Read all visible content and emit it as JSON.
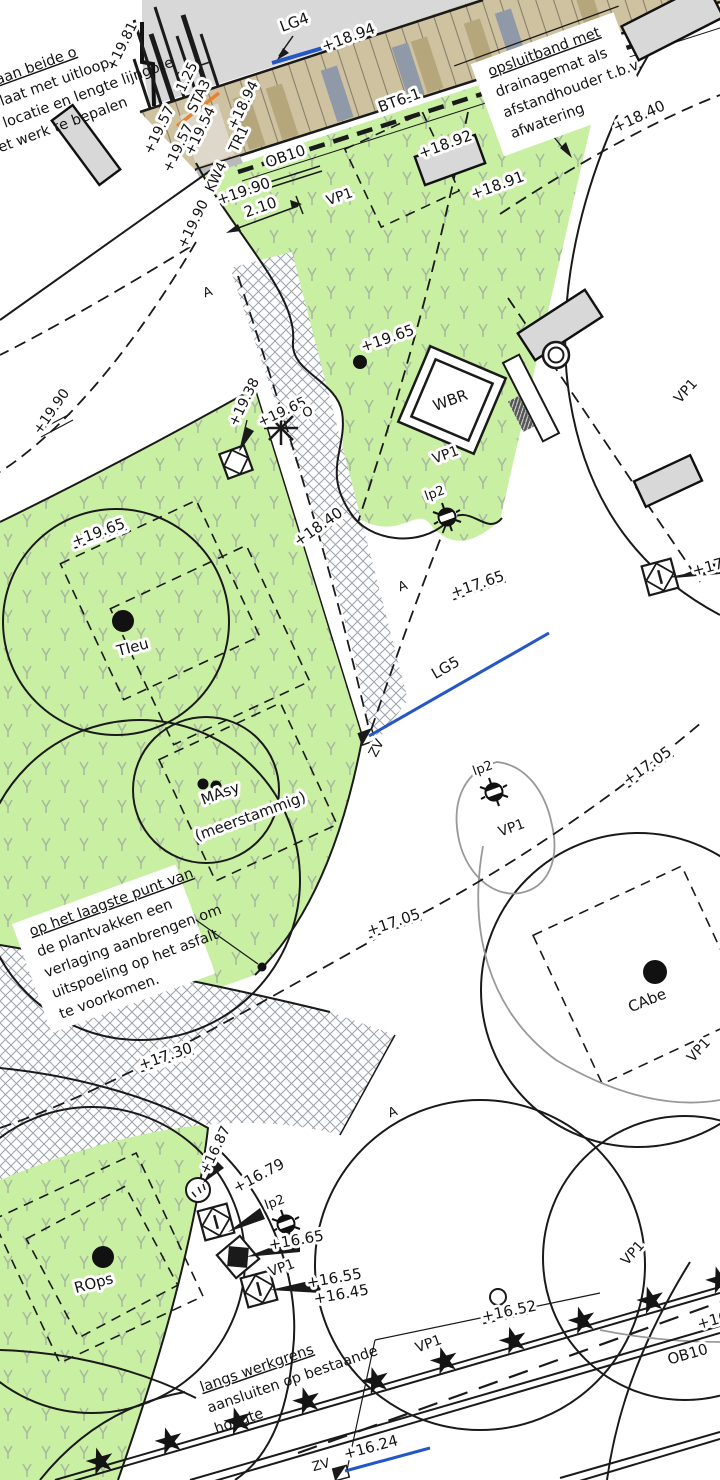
{
  "drawing": {
    "title": "landscape planting and paving plan detail",
    "colors": {
      "planting_green": "#c9efa3",
      "grass_mark": "#a6b89e",
      "hatch_grey": "#9aa2aa",
      "brick_base": "#cfc2a0",
      "brick_dark": "#b5a67c",
      "brick_grey": "#9099a8",
      "object_grey": "#d8d8d8",
      "line_blue": "#2456c8",
      "line_orange": "#e8822e"
    },
    "labels": {
      "lg4": "LG4",
      "e1894a": "+18.94",
      "bt61": "BT6-1",
      "e1892": "+18.92",
      "e1891": "+18.91",
      "e1894b": "+18.94",
      "e1981": "+19.81",
      "dim125": "1.25",
      "sta3": "STA3",
      "e1957a": "+19.57",
      "e1957b": "+19.57",
      "e1954": "+19.54",
      "tr1": "TR1",
      "kw4": "KW4",
      "ob10a": "OB10",
      "e1990a": "+19.90",
      "dim210": "2.10",
      "e1990b": "+19.90",
      "e1990c": "+19.90",
      "vp1a": "VP1",
      "e1840a": "+18.40",
      "vp1b": "VP1",
      "e1965a": "+19.65",
      "e1938": "+19.38",
      "e1965b": "+19.65",
      "e1965c": "+19.65",
      "wbr": "WBR",
      "vp1c": "VP1",
      "o_mark": "O",
      "lp2a": "lp2",
      "e1840b": "+18.40",
      "a1": "A",
      "a2": "A",
      "a3": "A",
      "tieu": "TIeu",
      "e1765": "+17.65",
      "lg5": "LG5",
      "zv1": "ZV",
      "masy1": "MAsy",
      "masy2": "(meerstammig)",
      "lp2b": "lp2",
      "vp1d": "VP1",
      "e1705a": "+17.05",
      "vp1e": "VP1",
      "cabe": "CAbe",
      "e1705b": "+17.05",
      "e1730": "+17.30",
      "vp1f": "VP1",
      "e1687": "+16.87",
      "e1679": "+16.79",
      "lp2c": "lp2",
      "e1665": "+16.65",
      "vp1g": "VP1",
      "e1655": "+16.55",
      "e1645": "+16.45",
      "rops": "ROps",
      "e1652": "+16.52",
      "vp1h": "VP1",
      "vp1i": "VP1",
      "ob10b": "OB10",
      "e16x": "+16",
      "e1624": "+16.24",
      "zv2": "ZV",
      "e17r": "+17.0"
    },
    "notes": {
      "n1": {
        "lines": [
          "t met aan beide o",
          "eindplaat met uitloop,",
          "acte locatie en lengte lijngote",
          "n het werk te bepalen"
        ]
      },
      "n2": {
        "lines": [
          "opsluitband met",
          "drainagemat als",
          "afstandhouder t.b.v.",
          "afwatering"
        ]
      },
      "n3": {
        "lines": [
          "op het laagste punt van",
          "de plantvakken een",
          "verlaging aanbrengen om",
          "uitspoeling op het asfalt",
          "te voorkomen."
        ]
      },
      "n4": {
        "lines": [
          "langs werkgrens",
          "aansluiten op bestaande",
          "hoogte"
        ]
      }
    },
    "stars_row": "★ ★ ★ ★ ★ ★ ★ ★ ★ ★ ★ ★ ★"
  }
}
